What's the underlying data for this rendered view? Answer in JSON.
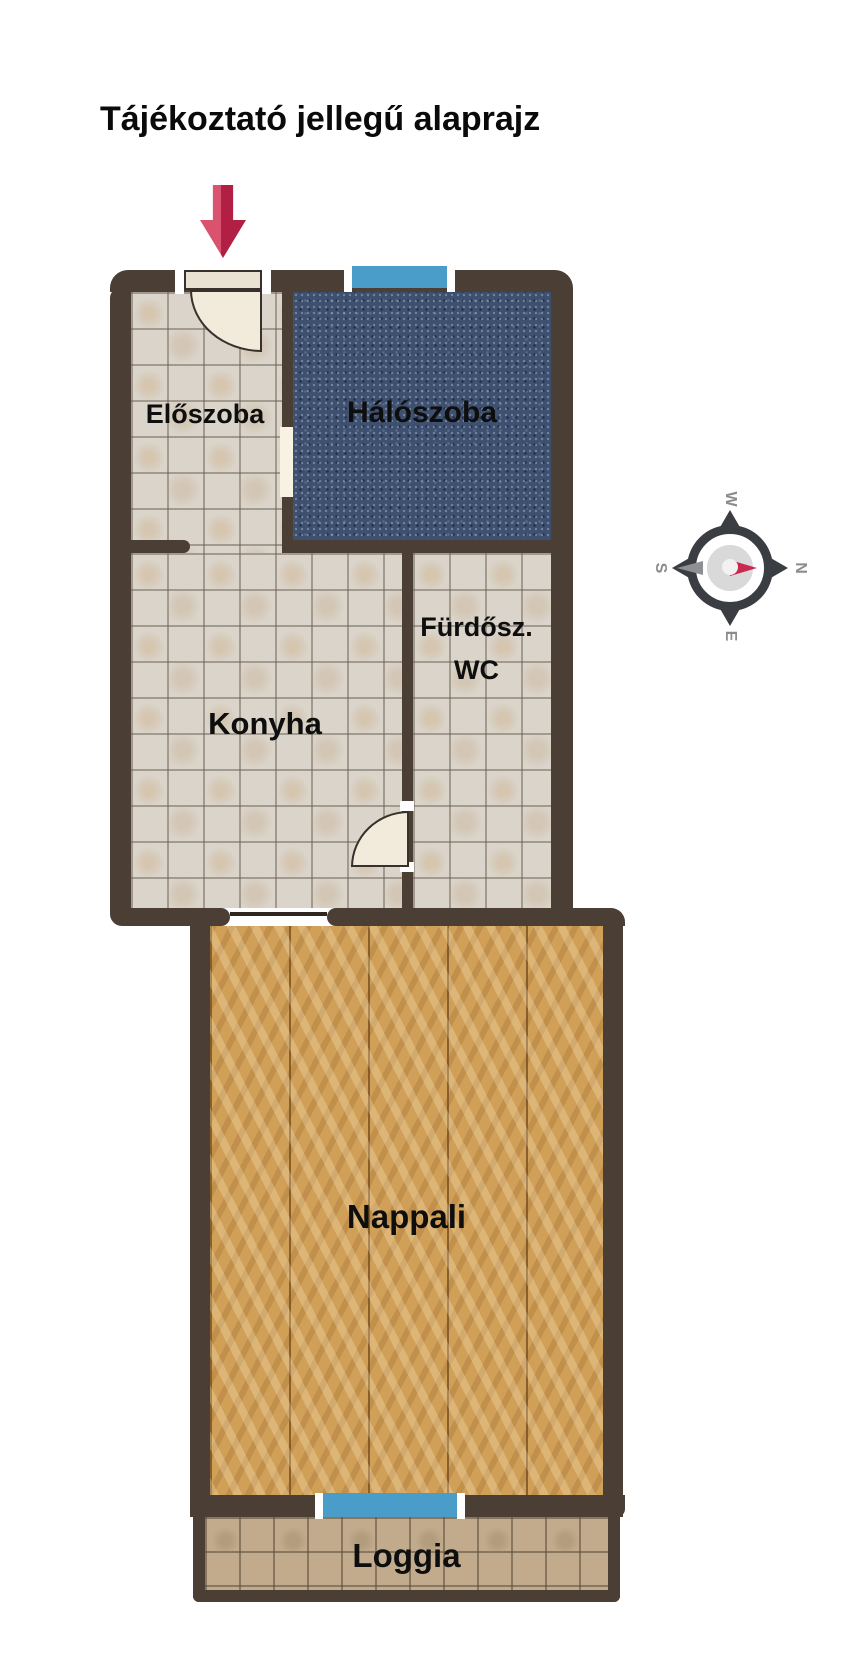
{
  "header": {
    "title": "Tájékoztató jellegű alaprajz"
  },
  "rooms": {
    "eloszoba": {
      "label": "Előszoba",
      "floor": "tile"
    },
    "haloszoba": {
      "label": "Hálószoba",
      "floor": "carpet"
    },
    "konyha": {
      "label": "Konyha",
      "floor": "tile"
    },
    "furdoszoba": {
      "line1": "Fürdősz.",
      "line2": "WC",
      "floor": "tile"
    },
    "nappali": {
      "label": "Nappali",
      "floor": "parquet"
    },
    "loggia": {
      "label": "Loggia",
      "floor": "tile"
    }
  },
  "compass": {
    "north": "N",
    "south": "S",
    "east": "E",
    "west": "W"
  },
  "icons": {
    "entrance_arrow": "down-arrow marking main entrance",
    "compass_rose": "compass rotated with north pointing right",
    "door_swing": "quarter-circle door swing",
    "window": "blue window strip"
  },
  "colors": {
    "wall": "#4a3e35",
    "tile_floor": "#dad4ca",
    "carpet": "#3e5070",
    "parquet": "#d0a058",
    "loggia_tile": "#c1ab8c",
    "window_blue": "#4b9dc9",
    "arrow_red": "#c9294e",
    "compass_needle_north": "#c9294e"
  }
}
